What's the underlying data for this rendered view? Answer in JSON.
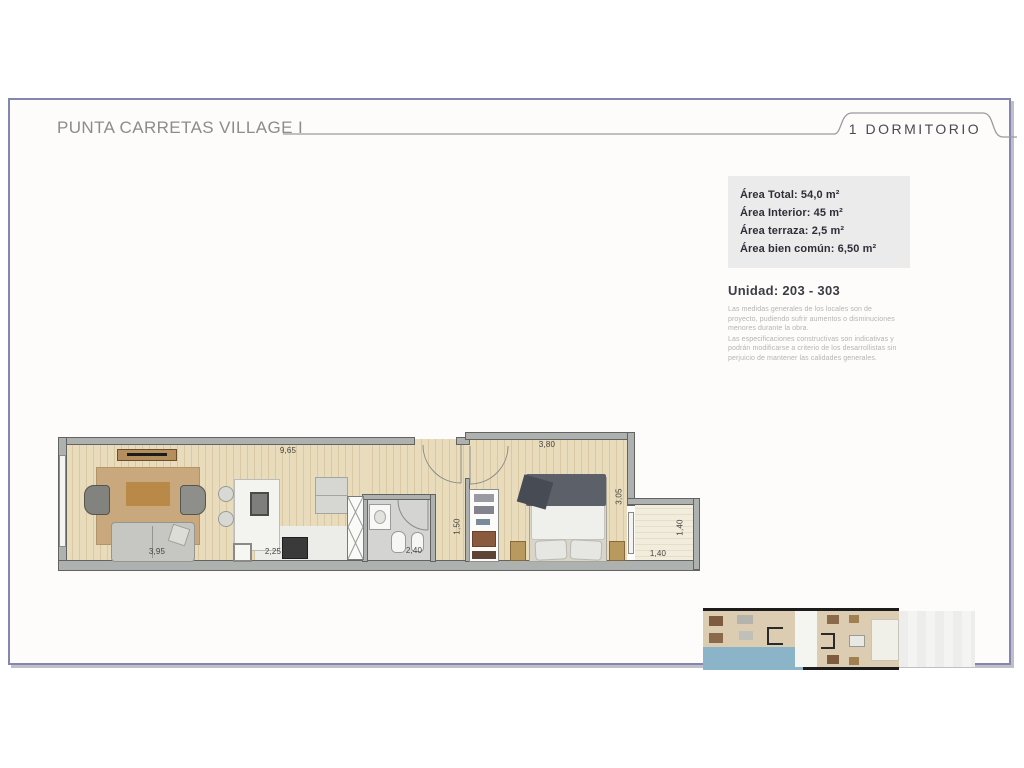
{
  "header": {
    "title": "PUNTA CARRETAS VILLAGE I",
    "unit_type": "1 DORMITORIO"
  },
  "info_box": {
    "lines": [
      "Área Total: 54,0 m²",
      "Área Interior: 45 m²",
      "Área terraza: 2,5 m²",
      "Área bien común: 6,50 m²"
    ]
  },
  "unit": {
    "label": "Unidad: 203 - 303"
  },
  "disclaimer": {
    "paragraph1": "Las medidas generales de los locales son de proyecto, pudiendo sufrir aumentos o disminuciones menores durante la obra.",
    "paragraph2": "Las especificaciones constructivas son indicativas y podrán modificarse a criterio de los desarrollistas sin perjuicio de mantener las calidades generales."
  },
  "floor_plan": {
    "dimensions": [
      {
        "value": "9,65"
      },
      {
        "value": "3,80"
      },
      {
        "value": "3,95"
      },
      {
        "value": "2,25"
      },
      {
        "value": "2,40"
      },
      {
        "value": "1,50"
      },
      {
        "value": "3,05"
      },
      {
        "value": "1,40"
      },
      {
        "value": "1,40"
      }
    ]
  },
  "colors": {
    "page_border": "#8585b2",
    "info_box_bg": "#ebebeb",
    "title_text": "#8c8c8c",
    "dark_text": "#2e2e38",
    "disclaimer_text": "#b4b4b4",
    "wood_floor": "#e9dcbd",
    "terrace_floor": "#f1ecdc",
    "pool_blue": "#8cb4c8"
  }
}
